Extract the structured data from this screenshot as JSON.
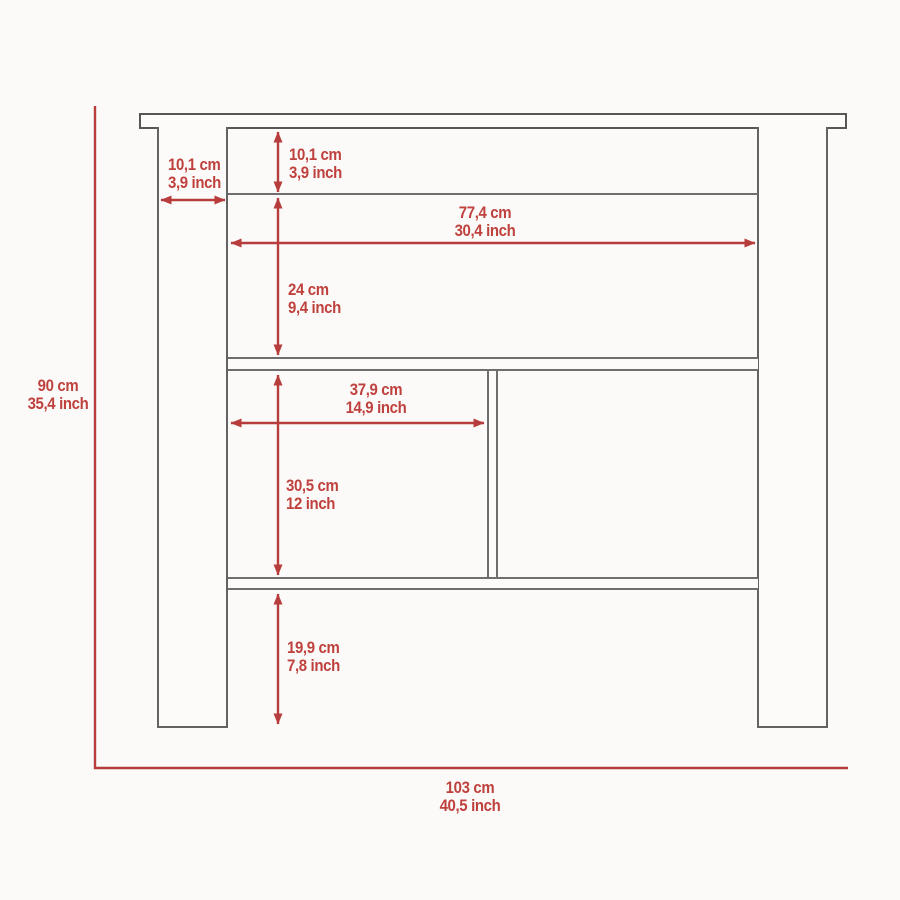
{
  "diagram": {
    "type": "furniture-dimension-drawing",
    "subject": "kitchen-island-front-view",
    "colors": {
      "dimension_red": "#b73d3c",
      "outline_gray": "#636363",
      "background": "#fbfaf8"
    },
    "overall": {
      "height": {
        "cm": "90 cm",
        "inch": "35,4 inch"
      },
      "width": {
        "cm": "103 cm",
        "inch": "40,5 inch"
      }
    },
    "dimensions": [
      {
        "id": "leg-width",
        "cm": "10,1 cm",
        "inch": "3,9 inch"
      },
      {
        "id": "top-frame-height",
        "cm": "10,1 cm",
        "inch": "3,9 inch"
      },
      {
        "id": "inner-width",
        "cm": "77,4 cm",
        "inch": "30,4 inch"
      },
      {
        "id": "upper-section-height",
        "cm": "24 cm",
        "inch": "9,4 inch"
      },
      {
        "id": "cubby-width",
        "cm": "37,9 cm",
        "inch": "14,9 inch"
      },
      {
        "id": "middle-section-height",
        "cm": "30,5 cm",
        "inch": "12 inch"
      },
      {
        "id": "bottom-clearance",
        "cm": "19,9 cm",
        "inch": "7,8 inch"
      }
    ]
  }
}
